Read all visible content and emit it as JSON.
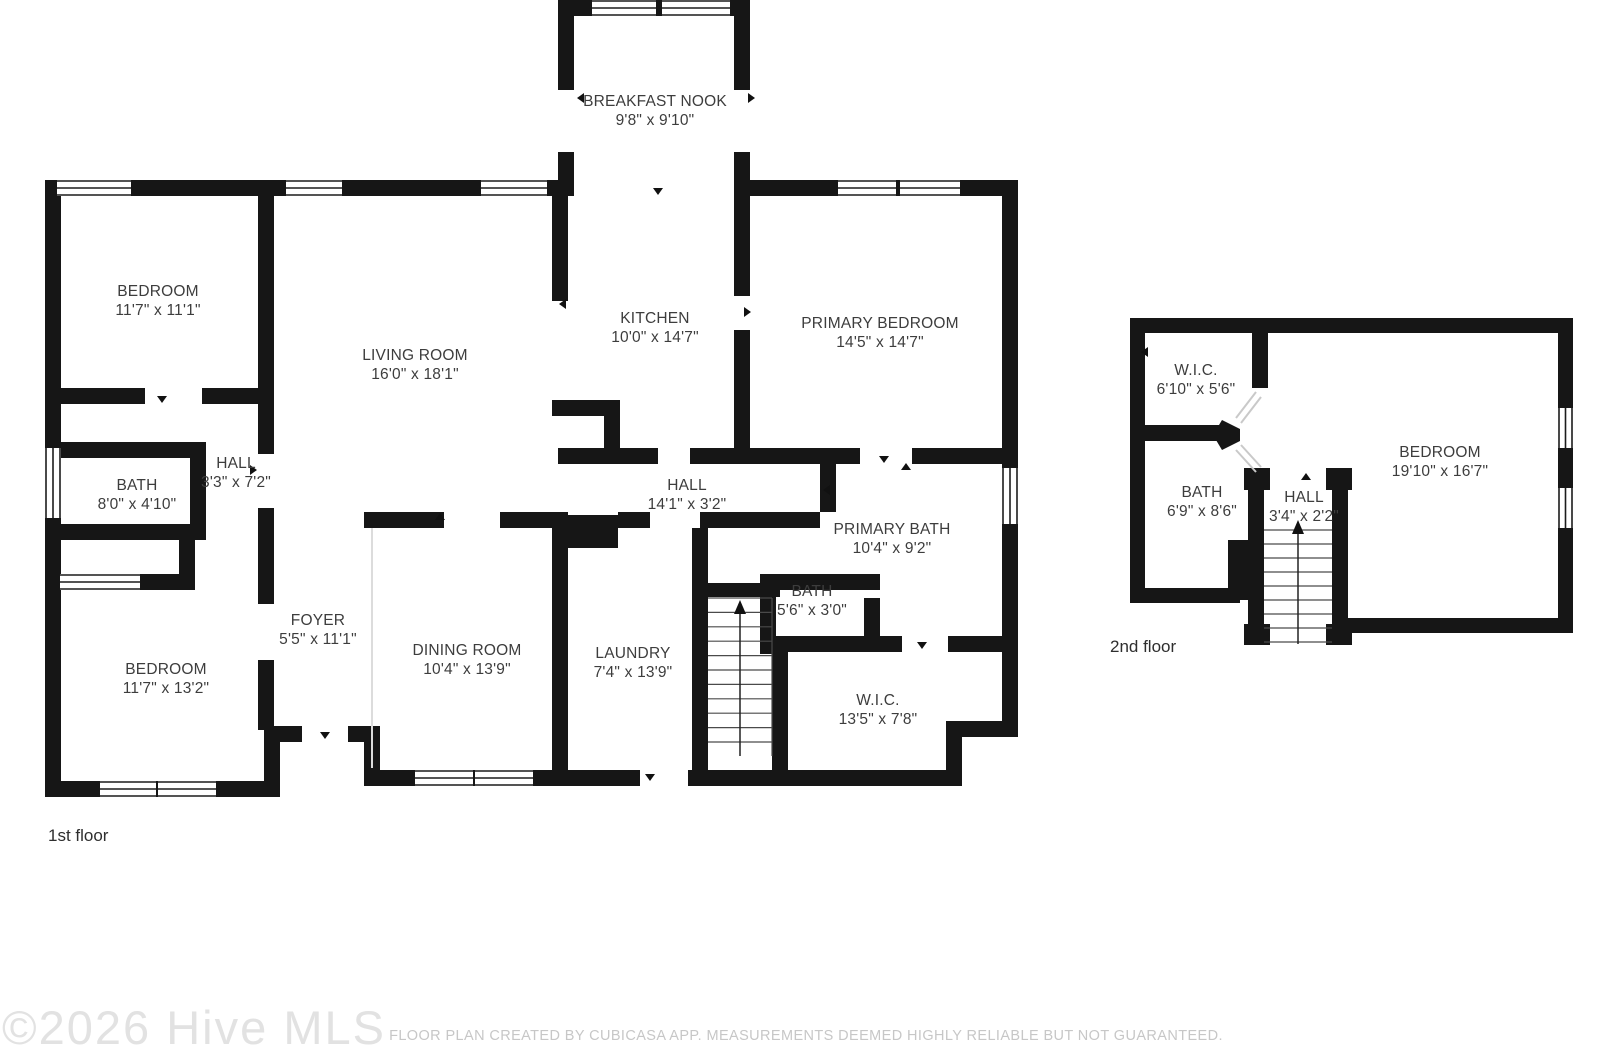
{
  "page": {
    "background": "#ffffff",
    "wall_color": "#161616",
    "label_color": "#3d3d3d",
    "watermark_color": "#e2e2e2",
    "disclaimer_color": "#c7c7c7"
  },
  "floors": [
    {
      "label": "1st floor",
      "rooms": [
        {
          "name": "BREAKFAST NOOK",
          "dims": "9'8\" x 9'10\""
        },
        {
          "name": "BEDROOM",
          "dims": "11'7\" x 11'1\""
        },
        {
          "name": "LIVING ROOM",
          "dims": "16'0\" x 18'1\""
        },
        {
          "name": "KITCHEN",
          "dims": "10'0\" x 14'7\""
        },
        {
          "name": "PRIMARY BEDROOM",
          "dims": "14'5\" x 14'7\""
        },
        {
          "name": "BATH",
          "dims": "8'0\" x 4'10\""
        },
        {
          "name": "HALL",
          "dims": "3'3\" x 7'2\""
        },
        {
          "name": "HALL",
          "dims": "14'1\" x 3'2\""
        },
        {
          "name": "PRIMARY BATH",
          "dims": "10'4\" x 9'2\""
        },
        {
          "name": "BATH",
          "dims": "5'6\" x 3'0\""
        },
        {
          "name": "W.I.C.",
          "dims": "13'5\" x 7'8\""
        },
        {
          "name": "FOYER",
          "dims": "5'5\" x 11'1\""
        },
        {
          "name": "DINING ROOM",
          "dims": "10'4\" x 13'9\""
        },
        {
          "name": "LAUNDRY",
          "dims": "7'4\" x 13'9\""
        },
        {
          "name": "BEDROOM",
          "dims": "11'7\" x 13'2\""
        }
      ]
    },
    {
      "label": "2nd floor",
      "rooms": [
        {
          "name": "W.I.C.",
          "dims": "6'10\" x 5'6\""
        },
        {
          "name": "BATH",
          "dims": "6'9\" x 8'6\""
        },
        {
          "name": "HALL",
          "dims": "3'4\" x 2'2\""
        },
        {
          "name": "BEDROOM",
          "dims": "19'10\" x 16'7\""
        }
      ]
    }
  ],
  "footer": {
    "watermark": "©2026 Hive MLS",
    "disclaimer": "FLOOR PLAN CREATED BY CUBICASA APP. MEASUREMENTS DEEMED HIGHLY RELIABLE BUT NOT GUARANTEED."
  }
}
